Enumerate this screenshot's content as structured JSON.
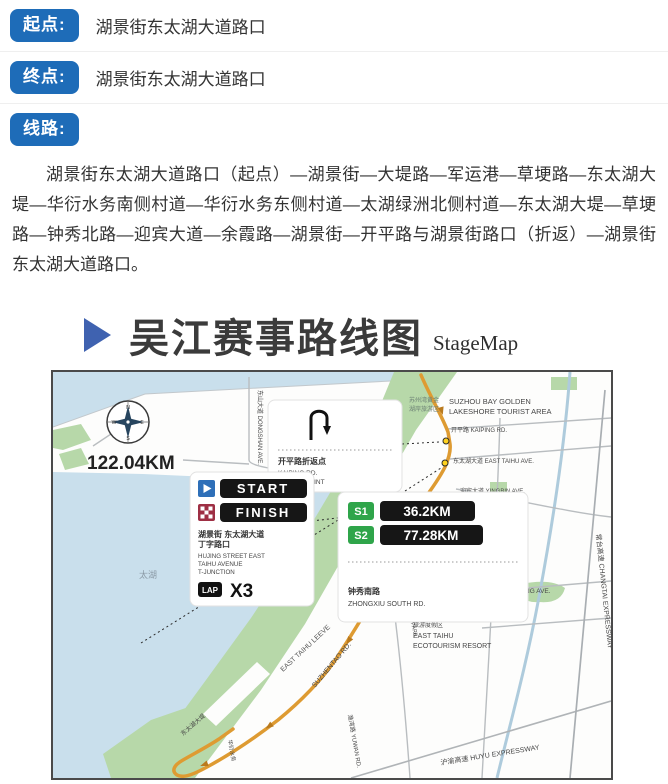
{
  "info": {
    "rows": [
      {
        "label": "起点:",
        "value": "湖景街东太湖大道路口"
      },
      {
        "label": "终点:",
        "value": "湖景街东太湖大道路口"
      },
      {
        "label": "线路:",
        "value": ""
      }
    ],
    "route_text": "湖景街东太湖大道路口（起点）—湖景街—大堤路—军运港—草埂路—东太湖大堤—华衍水务南侧村道—华衍水务东侧村道—太湖绿洲北侧村道—东太湖大堤—草埂路—钟秀北路—迎宾大道—余霞路—湖景街—开平路与湖景街路口（折返）—湖景街东太湖大道路口。"
  },
  "title": {
    "zh": "吴江赛事路线图",
    "en": "StageMap"
  },
  "map": {
    "total_distance": "122.04KM",
    "lake_label": "太湖",
    "compass": {
      "n": "N",
      "e": "E",
      "s": "S",
      "w": "W"
    },
    "uturn_card": {
      "zh": "开平路折返点",
      "en_line1": "KAIPING RD.",
      "en_line2": "U-TURN POINT"
    },
    "start_card": {
      "start": "START",
      "finish": "FINISH",
      "zh_line1": "湖景街 东太湖大道",
      "zh_line2": "丁字路口",
      "en_line1": "HUJING STREET EAST",
      "en_line2": "TAIHU AVENUE",
      "en_line3": "T-JUNCTION",
      "lap": "LAP",
      "lap_count": "X3"
    },
    "stage_card": {
      "s1": "S1",
      "s1_dist": "36.2KM",
      "s2": "S2",
      "s2_dist": "77.28KM",
      "zh": "钟秀南路",
      "en": "ZHONGXIU SOUTH RD."
    },
    "labels": {
      "tourist_area_zh1": "苏州湾黄金",
      "tourist_area_zh2": "湖岸旅游区",
      "tourist_area_en1": "SUZHOU BAY GOLDEN",
      "tourist_area_en2": "LAKESHORE TOURIST AREA",
      "kaiping_rd": "开平路 KAIPING RD.",
      "east_taihu_ave": "东太湖大道 EAST TAIHU AVE.",
      "yingbin_ave": "迎宾大道 YINGBIN AVE.",
      "dongshan_ave": "东山大道 DONGSHAN AVE.",
      "sports_park_zh1": "苏州湾",
      "sports_park_zh2": "体育公园",
      "sports_park_en": "SUZHOU BAY SPORTS PARK",
      "wujiang_ave": "吴江大道 WUJIANG AVE.",
      "resort_zh1": "东太湖生态",
      "resort_zh2": "旅游度假区",
      "resort_en1": "EAST TAIHU",
      "resort_en2": "ECOTOURISM RESORT",
      "east_taihu_levee_en": "EAST TAIHU LEEVE",
      "east_taihu_levee_zh": "东太湖大堤",
      "suzhentao_rd": "SUZHENTAO RD.",
      "yuwan_rd": "渔湾路 YUWAN RD.",
      "waterworks": "华衍水务",
      "changtai_expwy": "常台高速 CHANGTAI EXPRESSWAY",
      "huyu_expwy": "沪渝高速 HUYU EXPRESSWAY"
    }
  }
}
